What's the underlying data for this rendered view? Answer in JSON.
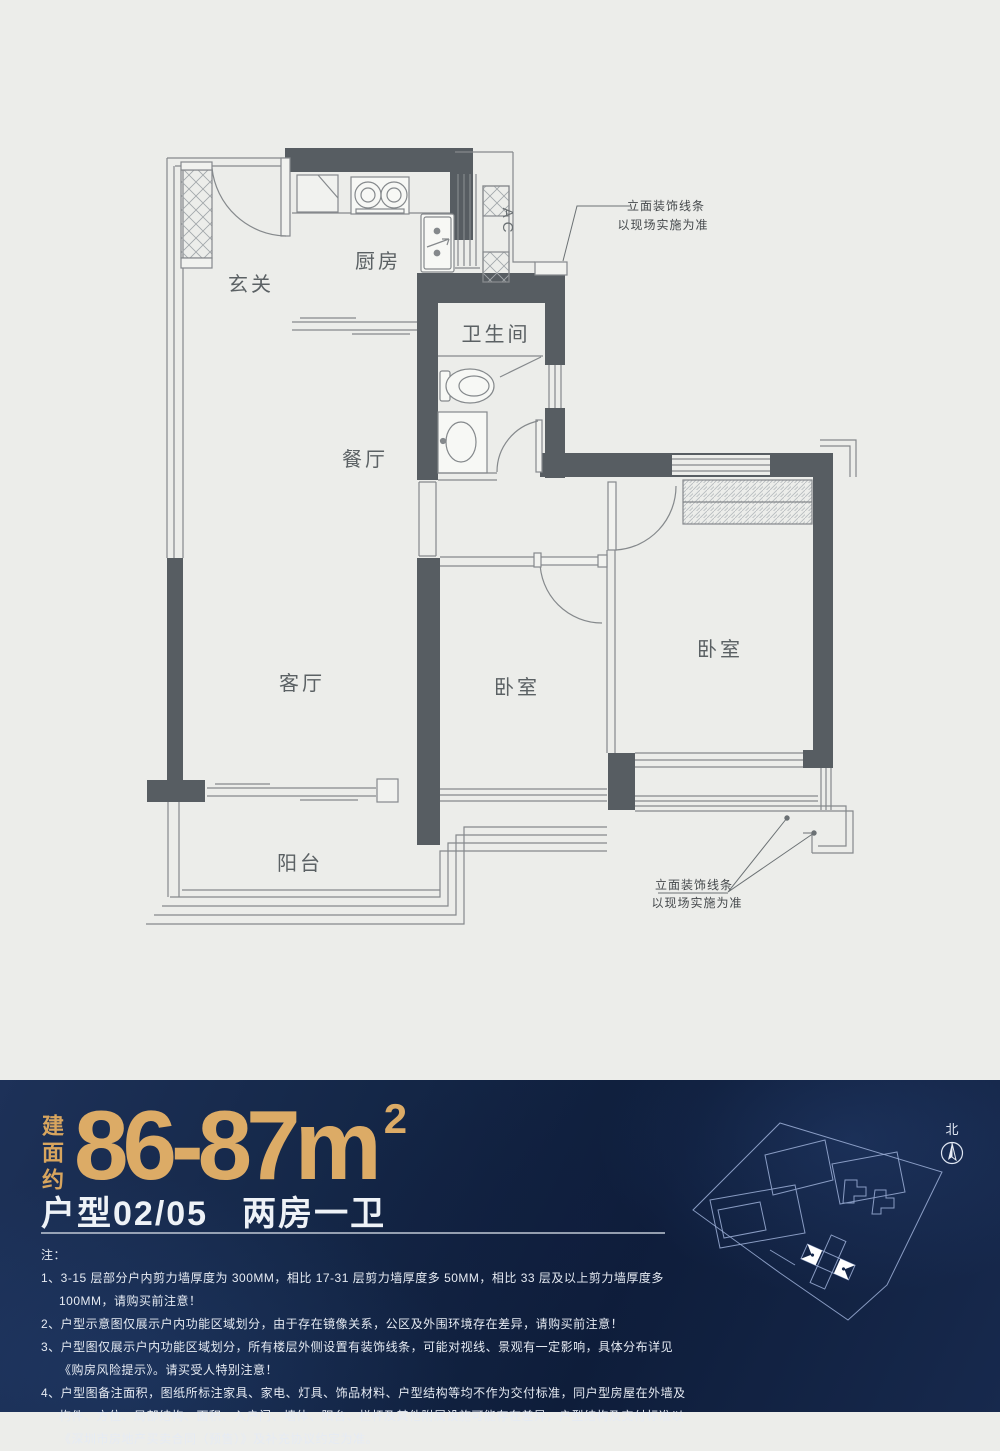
{
  "plan": {
    "rooms": {
      "foyer": "玄关",
      "kitchen": "厨房",
      "bathroom": "卫生间",
      "dining": "餐厅",
      "living": "客厅",
      "bedroom_small": "卧室",
      "bedroom_master": "卧室",
      "balcony": "阳台"
    },
    "ac_label": "AC",
    "facade_note": {
      "line1": "立面装饰线条",
      "line2": "以现场实施为准"
    }
  },
  "panel": {
    "area_prefix": "建面约",
    "area_value": "86-87m",
    "area_sup": "2",
    "unit_code": "户型02/05",
    "unit_type": "两房一卫",
    "notes_label": "注：",
    "notes": [
      "1、3-15 层部分户内剪力墙厚度为 300MM，相比 17-31 层剪力墙厚度多 50MM，相比 33 层及以上剪力墙厚度多 100MM，请购买前注意！",
      "2、户型示意图仅展示户内功能区域划分，由于存在镜像关系，公区及外围环境存在差异，请购买前注意！",
      "3、户型图仅展示户内功能区域划分，所有楼层外侧设置有装饰线条，可能对视线、景观有一定影响，具体分布详见《购房风险提示》。请买受人特别注意！",
      "4、户型图备注面积，图纸所标注家具、家电、灯具、饰品材料、户型结构等均不作为交付标准，同户型房屋在外墙及构件、方位、局部结构、面积、入户门、墙体、阳台、栏杆及其他附属设施可能存在差异，户型结构及交付标准以《深圳市房地产买卖合同（预售）》及补充协议约定为准。"
    ],
    "north_label": "北"
  },
  "colors": {
    "accent_gold": "#d9a75f",
    "panel_bg": "#13264a",
    "wall_gray": "#575d62"
  }
}
